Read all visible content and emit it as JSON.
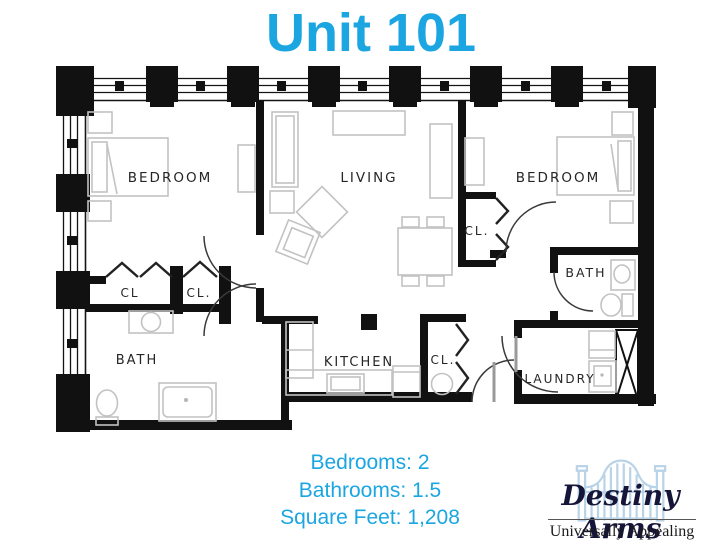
{
  "title": "Unit 101",
  "colors": {
    "accent": "#1BA6E2",
    "logo_gate": "#B9D3E7",
    "plan_ink": "#111111"
  },
  "floorplan": {
    "labels": {
      "bedroom_left": "BEDROOM",
      "living": "LIVING",
      "bedroom_right": "BEDROOM",
      "closet_1": "CL",
      "closet_2": "CL.",
      "closet_mid": "CL.",
      "bath_main": "BATH",
      "kitchen": "KITCHEN",
      "closet_kitchen": "CL.",
      "bath_half": "BATH",
      "laundry": "LAUNDRY"
    }
  },
  "details": {
    "lines": [
      "Bedrooms: 2",
      "Bathrooms: 1.5",
      "Square Feet: 1,208"
    ]
  },
  "logo": {
    "name": "Destiny Arms",
    "tagline": "Universally Appealing"
  }
}
